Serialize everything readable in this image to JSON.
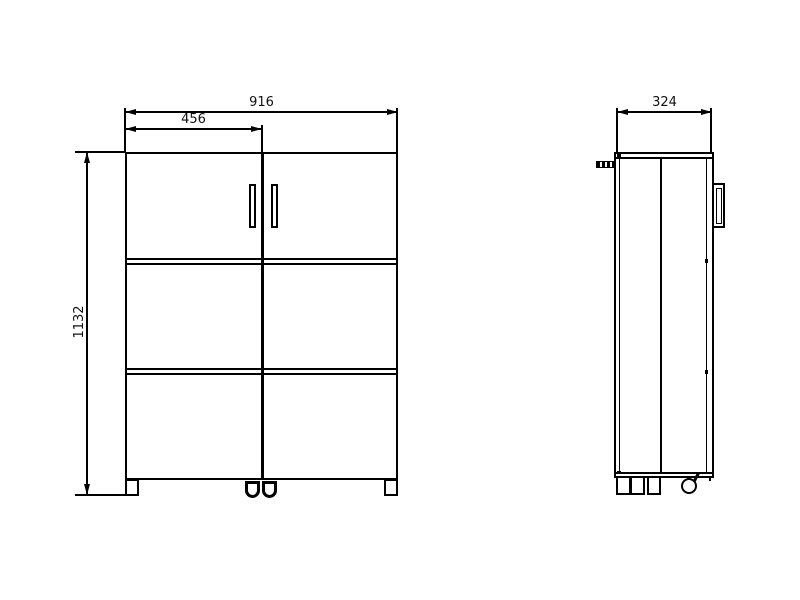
{
  "drawing": {
    "background": "#ffffff",
    "line_color": "#000000",
    "views": {
      "front": {
        "name": "front view"
      },
      "side": {
        "name": "side view"
      }
    },
    "dimensions": {
      "overall_width": "916",
      "door_width": "456",
      "overall_height": "1132",
      "depth": "324"
    }
  }
}
